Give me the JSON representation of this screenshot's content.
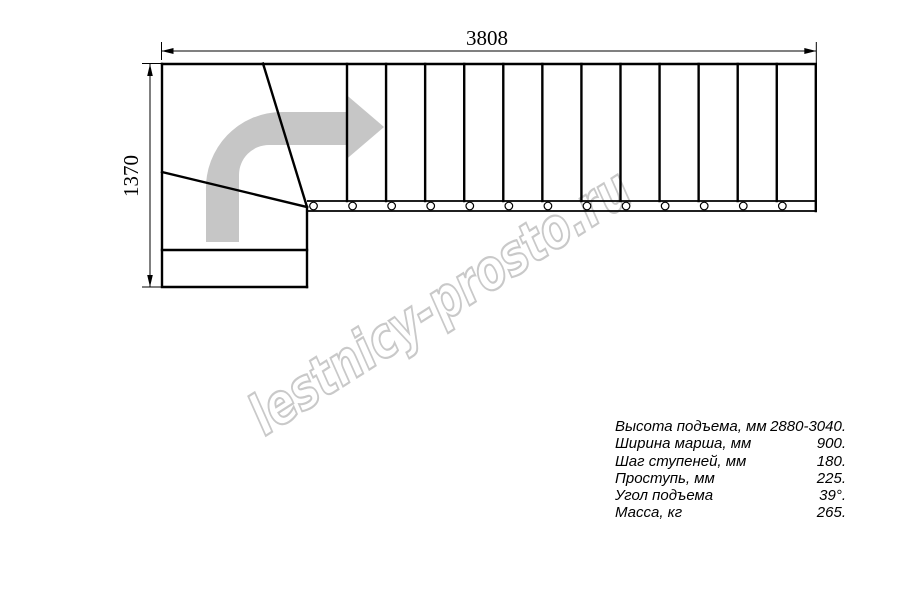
{
  "drawing": {
    "type": "staircase-plan-top-view",
    "dimension_width_mm": "3808",
    "dimension_height_mm": "1370",
    "watermark_text": "lestnicy-prosto.ru",
    "colors": {
      "line": "#000000",
      "arrow": "#c6c6c6",
      "watermark": "#c9c9c9",
      "background": "#ffffff"
    },
    "plan": {
      "tread_line_count": 12,
      "first_tread_x": 347,
      "tread_spacing": 39.07,
      "tread_top_y": 64,
      "tread_bottom_y": 201,
      "baluster_count": 13,
      "first_baluster_x": 313.5,
      "baluster_spacing": 39.07,
      "baluster_y": 206,
      "baluster_r": 3.8
    }
  },
  "specs": {
    "rows": [
      {
        "label": "Высота подъема, мм",
        "value": "2880-3040."
      },
      {
        "label": "Ширина марша, мм",
        "value": "900."
      },
      {
        "label": "Шаг ступеней, мм",
        "value": "180."
      },
      {
        "label": "Проступь, мм",
        "value": "225."
      },
      {
        "label": "Угол подъема",
        "value": "39°."
      },
      {
        "label": "Масса, кг",
        "value": "265."
      }
    ]
  }
}
